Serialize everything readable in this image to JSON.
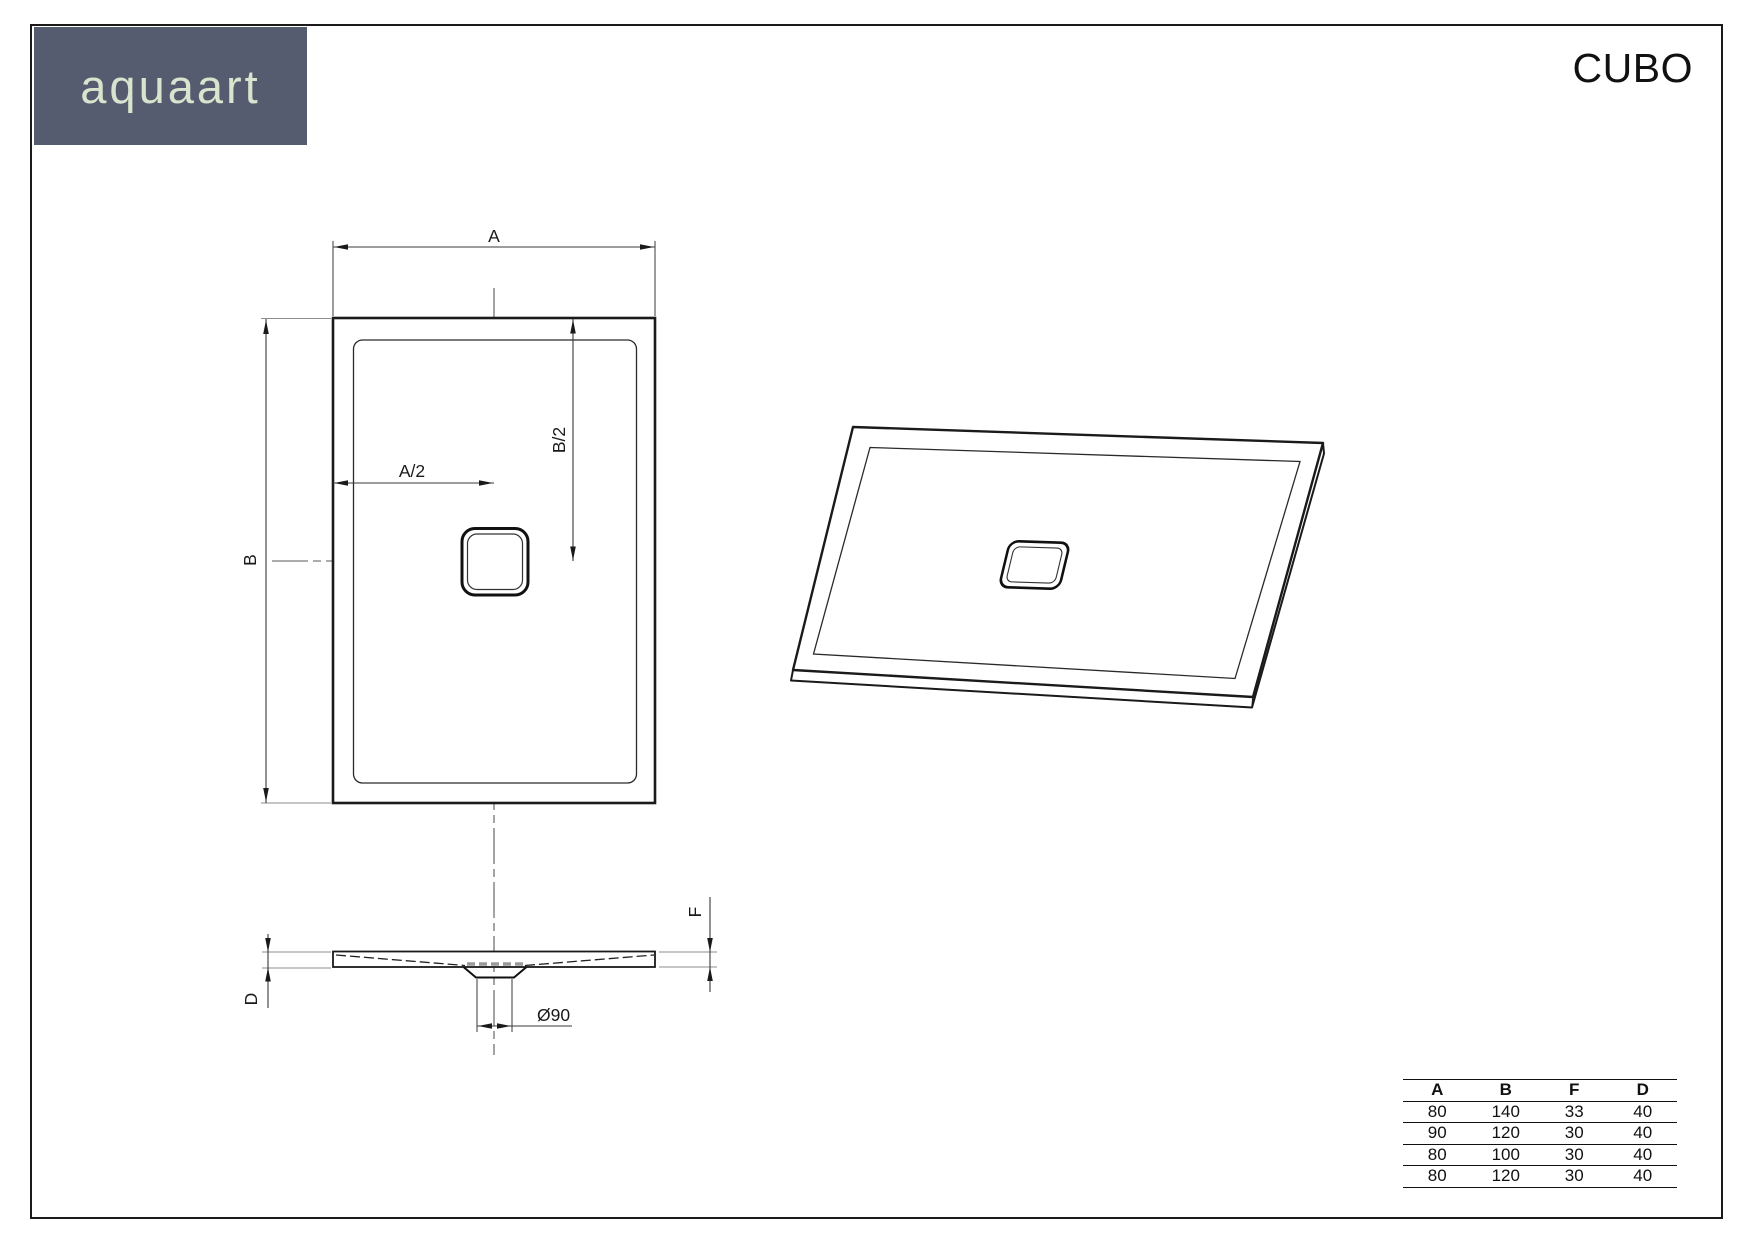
{
  "title": "CUBO",
  "logo": {
    "text": "aquaart",
    "bg_color": "#565c70",
    "text_color": "#d8e4ce"
  },
  "drawing": {
    "labels": {
      "a": "A",
      "b": "B",
      "a_half": "A/2",
      "b_half": "B/2",
      "f": "F",
      "d": "D",
      "drain_diameter": "Ø90"
    }
  },
  "size_table": {
    "headers": [
      "A",
      "B",
      "F",
      "D"
    ],
    "rows": [
      [
        "80",
        "140",
        "33",
        "40"
      ],
      [
        "90",
        "120",
        "30",
        "40"
      ],
      [
        "80",
        "100",
        "30",
        "40"
      ],
      [
        "80",
        "120",
        "30",
        "40"
      ]
    ]
  }
}
